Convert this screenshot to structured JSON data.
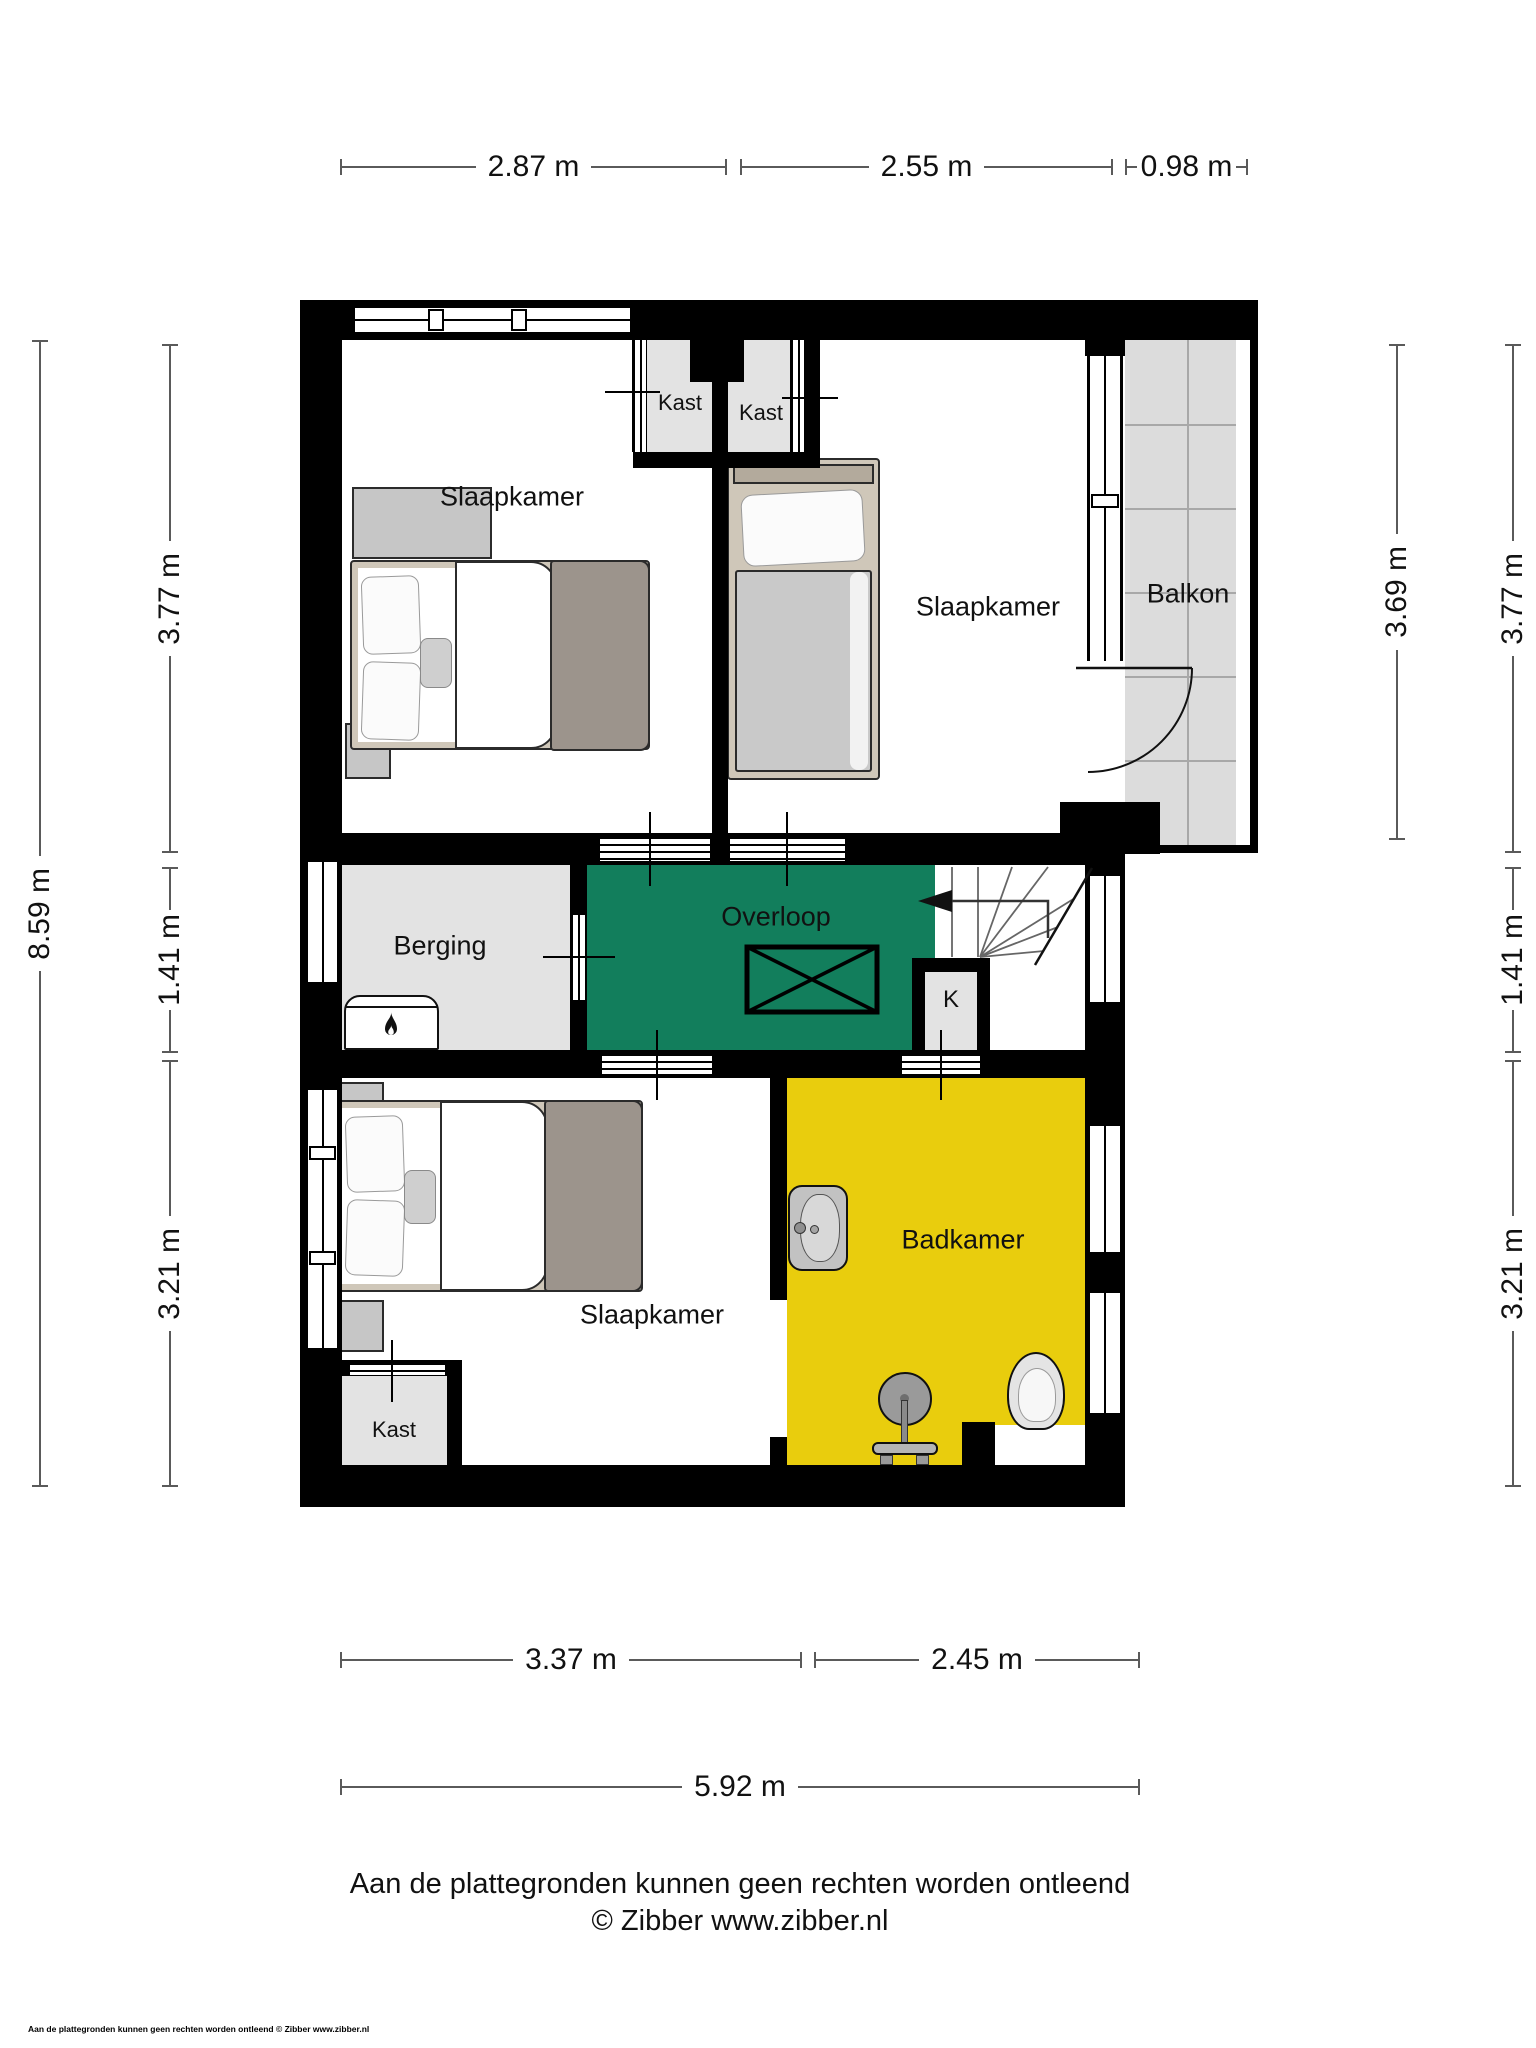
{
  "title": "Floor plan - verdieping (Zibber plattegrond)",
  "rooms": {
    "slaapkamer_top_left": "Slaapkamer",
    "kast_top_1": "Kast",
    "kast_top_2": "Kast",
    "slaapkamer_top_right": "Slaapkamer",
    "balkon": "Balkon",
    "berging": "Berging",
    "overloop": "Overloop",
    "meterkast": "K",
    "slaapkamer_bottom": "Slaapkamer",
    "badkamer": "Badkamer",
    "kast_bottom": "Kast"
  },
  "dimensions": {
    "top": [
      "2.87 m",
      "2.55 m",
      "0.98 m"
    ],
    "left_outer": "8.59 m",
    "left_inner": [
      "3.77 m",
      "1.41 m",
      "3.21 m"
    ],
    "right_inner": "3.69 m",
    "right_outer": [
      "3.77 m",
      "1.41 m",
      "3.21 m"
    ],
    "bottom": [
      "3.37 m",
      "2.45 m"
    ],
    "bottom_total": "5.92 m"
  },
  "footer": {
    "disclaimer": "Aan de plattegronden kunnen geen rechten worden ontleend",
    "credit": "© Zibber www.zibber.nl",
    "fineprint": "Aan de plattegronden kunnen geen rechten worden ontleend © Zibber www.zibber.nl"
  },
  "icons": {
    "boiler": "flame-icon",
    "stairs_direction": "arrow-left-icon",
    "floor_void": "x-box-icon"
  },
  "colors": {
    "overloop_green": "#127e5c",
    "badkamer_yellow": "#e9cd0d",
    "room_gray": "#e3e3e3",
    "balcony_gray": "#dcdcdc",
    "wall_black": "#000000",
    "bed_frame": "#cfc7b9",
    "blanket_gray": "#9c948c"
  }
}
